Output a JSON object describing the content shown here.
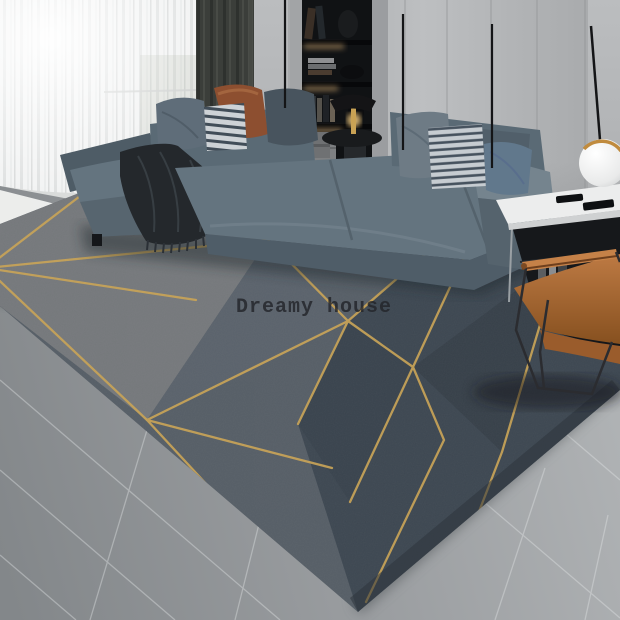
{
  "image": {
    "type": "product-photo",
    "subject": "geometric gold-line rug staged in a modern living room",
    "watermark": {
      "text": "Dreamy house"
    }
  },
  "scene": {
    "elements": [
      "sheer window curtains with sunlight",
      "dark blackout curtain panel",
      "built-in black display shelving with warm LED strips",
      "gray wardrobe cabinet wall with vertical seams and slim black handles",
      "L-shaped blue-gray sectional sofa",
      "throw pillows: gray, navy-striped, rust, slate, gray, striped, steel blue",
      "dark fringed throw blanket on chaise",
      "black round side table with brass lamp",
      "white-top black side table with remote controls and books",
      "white sphere floor lamp with gold rim",
      "cognac leather sling armchair with black metal frame",
      "dark gray geometric rug with gold triangular line pattern",
      "gray tile floor with sunlit strip by the window"
    ]
  },
  "colors": {
    "wall": "#b6b8ba",
    "cabinet": "#afb1b3",
    "cabinet-seam": "#909294",
    "shelf-dark": "#121416",
    "shelf-glow": "#dfb276",
    "curtain-sheer": "#f2f3f3",
    "curtain-dark": "#3b3e3a",
    "sofa": "#64747f",
    "sofa-dark": "#4e5c66",
    "sofa-light": "#75848e",
    "pillow-gray": "#5f6d79",
    "pillow-stripe-light": "#cdd2d6",
    "pillow-stripe-dark": "#414d58",
    "pillow-rust": "#8d4f30",
    "pillow-blue": "#61788c",
    "pillow-slate": "#48545e",
    "throw": "#24282c",
    "rug-light": "#75787b",
    "rug-mid": "#565e66",
    "rug-dark": "#3d4751",
    "rug-gold": "#c8a355",
    "floor": "#9a9da0",
    "grout": "#e3e6e7",
    "sunlit-floor": "#f4f5f3",
    "table-top": "#eceded",
    "table-body": "#16181b",
    "chrome": "#9aa0a4",
    "leather": "#b06f3e",
    "leather-dark": "#8d5427",
    "frame-black": "#2b2c30",
    "lamp-gold": "#c08b3e",
    "brass": "#c9a254",
    "watermark": "#23252a"
  }
}
